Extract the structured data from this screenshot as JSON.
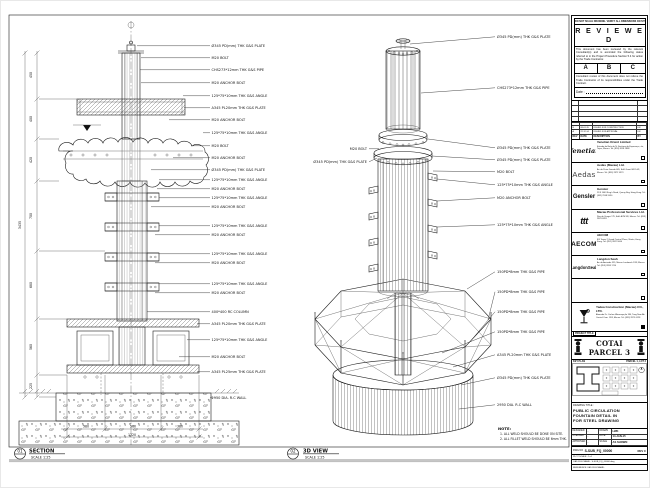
{
  "views": {
    "section": {
      "num": "01",
      "name": "SECTION",
      "scale": "SCALE 1:25"
    },
    "iso": {
      "num": "02",
      "name": "3D VIEW",
      "scale": "SCALE 1:25"
    }
  },
  "note": {
    "title": "NOTE:",
    "line1": "1. ALL WELD SHOULD BE DONE ON SITE.",
    "line2": "2. ALL FILLET WELD SHOULD BE 6mm THK."
  },
  "section_callouts": [
    "Ø345 PD(mm) THK G&S PLATE",
    "M20 BOLT",
    "CHS273*12mm THK G&S PIPE",
    "M20 ANCHOR BOLT",
    "125*75*10mm THK G&S ANGLE",
    "A345 PL20mm THK G&S PLATE",
    "M20 ANCHOR BOLT",
    "125*75*10mm THK G&S ANGLE",
    "M20 BOLT",
    "M20 ANCHOR BOLT",
    "Ø345 PD(mm) THK G&S PLATE",
    "125*75*10mm THK G&S ANGLE",
    "M20 ANCHOR BOLT",
    "125*75*10mm THK G&S ANGLE",
    "M20 ANCHOR BOLT",
    "125*75*10mm THK G&S ANGLE",
    "M20 ANCHOR BOLT",
    "125*75*10mm THK G&S ANGLE",
    "M20 ANCHOR BOLT",
    "125*75*10mm THK G&S ANGLE",
    "M20 ANCHOR BOLT",
    "400*400 RC COLUMN",
    "A345 PL20mm THK G&S PLATE",
    "125*75*10mm THK G&S ANGLE",
    "M20 ANCHOR BOLT",
    "A345 PL25mm THK G&S PLATE",
    "2950 DIA. R.C WALL"
  ],
  "iso_callouts": [
    "Ø345 PD(mm) THK G&S PLATE",
    "CHS273*12mm THK G&S PIPE",
    "Ø345 PD(mm) THK G&S PLATE",
    "Ø345 PD(mm) THK G&S PLATE",
    "M20 BOLT",
    "125*75*10mm THK G&S ANGLE",
    "M20 ANCHOR BOLT",
    "125*75*10mm THK G&S ANGLE",
    "150PD*8mm THK G&S PIPE",
    "150PD*8mm THK G&S PIPE",
    "150PD*8mm THK G&S PIPE",
    "150PD*8mm THK G&S PIPE",
    "A345 PL20mm THK G&S PLATE",
    "Ø345 PD(mm) THK G&S PLATE",
    "2950 DIA. R.C WALL"
  ],
  "iso_callouts_left": [
    "M20 BOLT",
    "Ø345 PD(mm) THK G&S PLATE"
  ],
  "dims": {
    "left": [
      "450",
      "400",
      "420",
      "700",
      "680",
      "560",
      "225"
    ],
    "left_total": "3435",
    "bottom": [
      "380",
      "560",
      "380"
    ],
    "bottom_total": "1320"
  },
  "stamp": {
    "top_note": "DO NOT SCALE DRAWING. VERIFY ALL DIMENSIONS ON SITE.",
    "title": "R E V I E W E D",
    "para1": "This document has been reviewed by the relevant Consultant(s) and is accorded the following status referred to in the Project Procedure Section 5.4 for action by the Trade Contractor.",
    "grades": [
      "A",
      "B",
      "C"
    ],
    "para2": "Consultant review of this document does not relieve the Trade Contractor of its responsibilities under the Trade Contract.",
    "date_label": "Date :"
  },
  "rev_table": {
    "headers": [
      "REV",
      "DATE",
      "DESCRIPTION",
      "BY"
    ],
    "rows": [
      {
        "rev": "C",
        "date": "15-01-15",
        "desc": "RE-ISSUED FOR CONSTRUCTION",
        "by": "LW"
      },
      {
        "rev": "B",
        "date": "08-01-15",
        "desc": "ISSUED FOR CONSTRUCTION",
        "by": "LW"
      },
      {
        "rev": "A",
        "date": "22-12-14",
        "desc": "ISSUED FOR APPROVAL",
        "by": "LW"
      }
    ]
  },
  "companies": [
    {
      "logo": "Venetian",
      "name": "Venetian Orient Limited",
      "address": "Estrada da Baía de N. Senhora da Esperança, s/n, Taipa, Macau. Tel: (853) 8118 2888"
    },
    {
      "logo": "Aedas",
      "name": "Aedas (Macau) Ltd.",
      "address": "Av. da Praia Grande 665, Edif. Great Will 14/F, Macau. Tel: (853) 2871 9373"
    },
    {
      "logo": "Gensler",
      "name": "Gensler",
      "address": "21/F 1063 King's Road, Quarry Bay, Hong Kong. Tel: (852) 2598 9990"
    },
    {
      "logo": "ttt",
      "name": "Macau Professional Services Ltd.",
      "address": "Rua de Xangai 175, Edif. ACM 9/F, Macau. Tel: (853) 2878 6281"
    },
    {
      "logo": "AECOM",
      "name": "AECOM",
      "address": "8/F Tower 2 Grand Central Plaza, Shatin, Hong Kong. Tel: (852) 3922 9000"
    },
    {
      "logo": "LangdonSeah",
      "name": "Langdon Seah",
      "address": "Av. da Amizade 555, Macau Landmark 13/F, Macau. Tel: (853) 2833 1710"
    },
    {
      "logo": "",
      "name": "",
      "address": ""
    }
  ],
  "contractor": {
    "name": "Yadea Construction (Macau) CO., LTD.",
    "address": "Alameda Dr. Carlos d'Assumpção 180, Tong Nam Ah Central Com. 19/F, Macau. Tel: (853) 2875 0128"
  },
  "project": {
    "label": "PROJECT TITLE",
    "title": "COTAI PARCEL 3"
  },
  "key_plan": {
    "label": "KEY PLAN",
    "right_label": "PARCEL 1, LOT 2"
  },
  "drawing_title": {
    "label": "DRAWING TITLE :",
    "line1": "PUBLIC CIRCULATION",
    "line2": "FOUNTAIN DETAIL IN",
    "line3": "FOR STEEL DRAWING"
  },
  "fields": {
    "designed_label": "DESIGNED",
    "designed": "-",
    "drawn_label": "DRAWN",
    "drawn": "LWK",
    "checked_label": "CHECKED",
    "checked": "-",
    "date_label": "DATE",
    "date": "14-JAN-15",
    "approved_label": "APPROVED",
    "approved": "-",
    "scale_label": "SCALE",
    "scale": "AS SHOWN"
  },
  "dwg": {
    "label": "DWG NO",
    "no": "S-SUB_FQ_00000",
    "rev": "REV  C"
  },
  "cad": {
    "row1": "PLOT SCALE : 1=1",
    "row2": "CAD FILE NAME : S-SUB_FQ_00000.dwg",
    "row3": "REFERENCE CAD FILE NAME :"
  }
}
